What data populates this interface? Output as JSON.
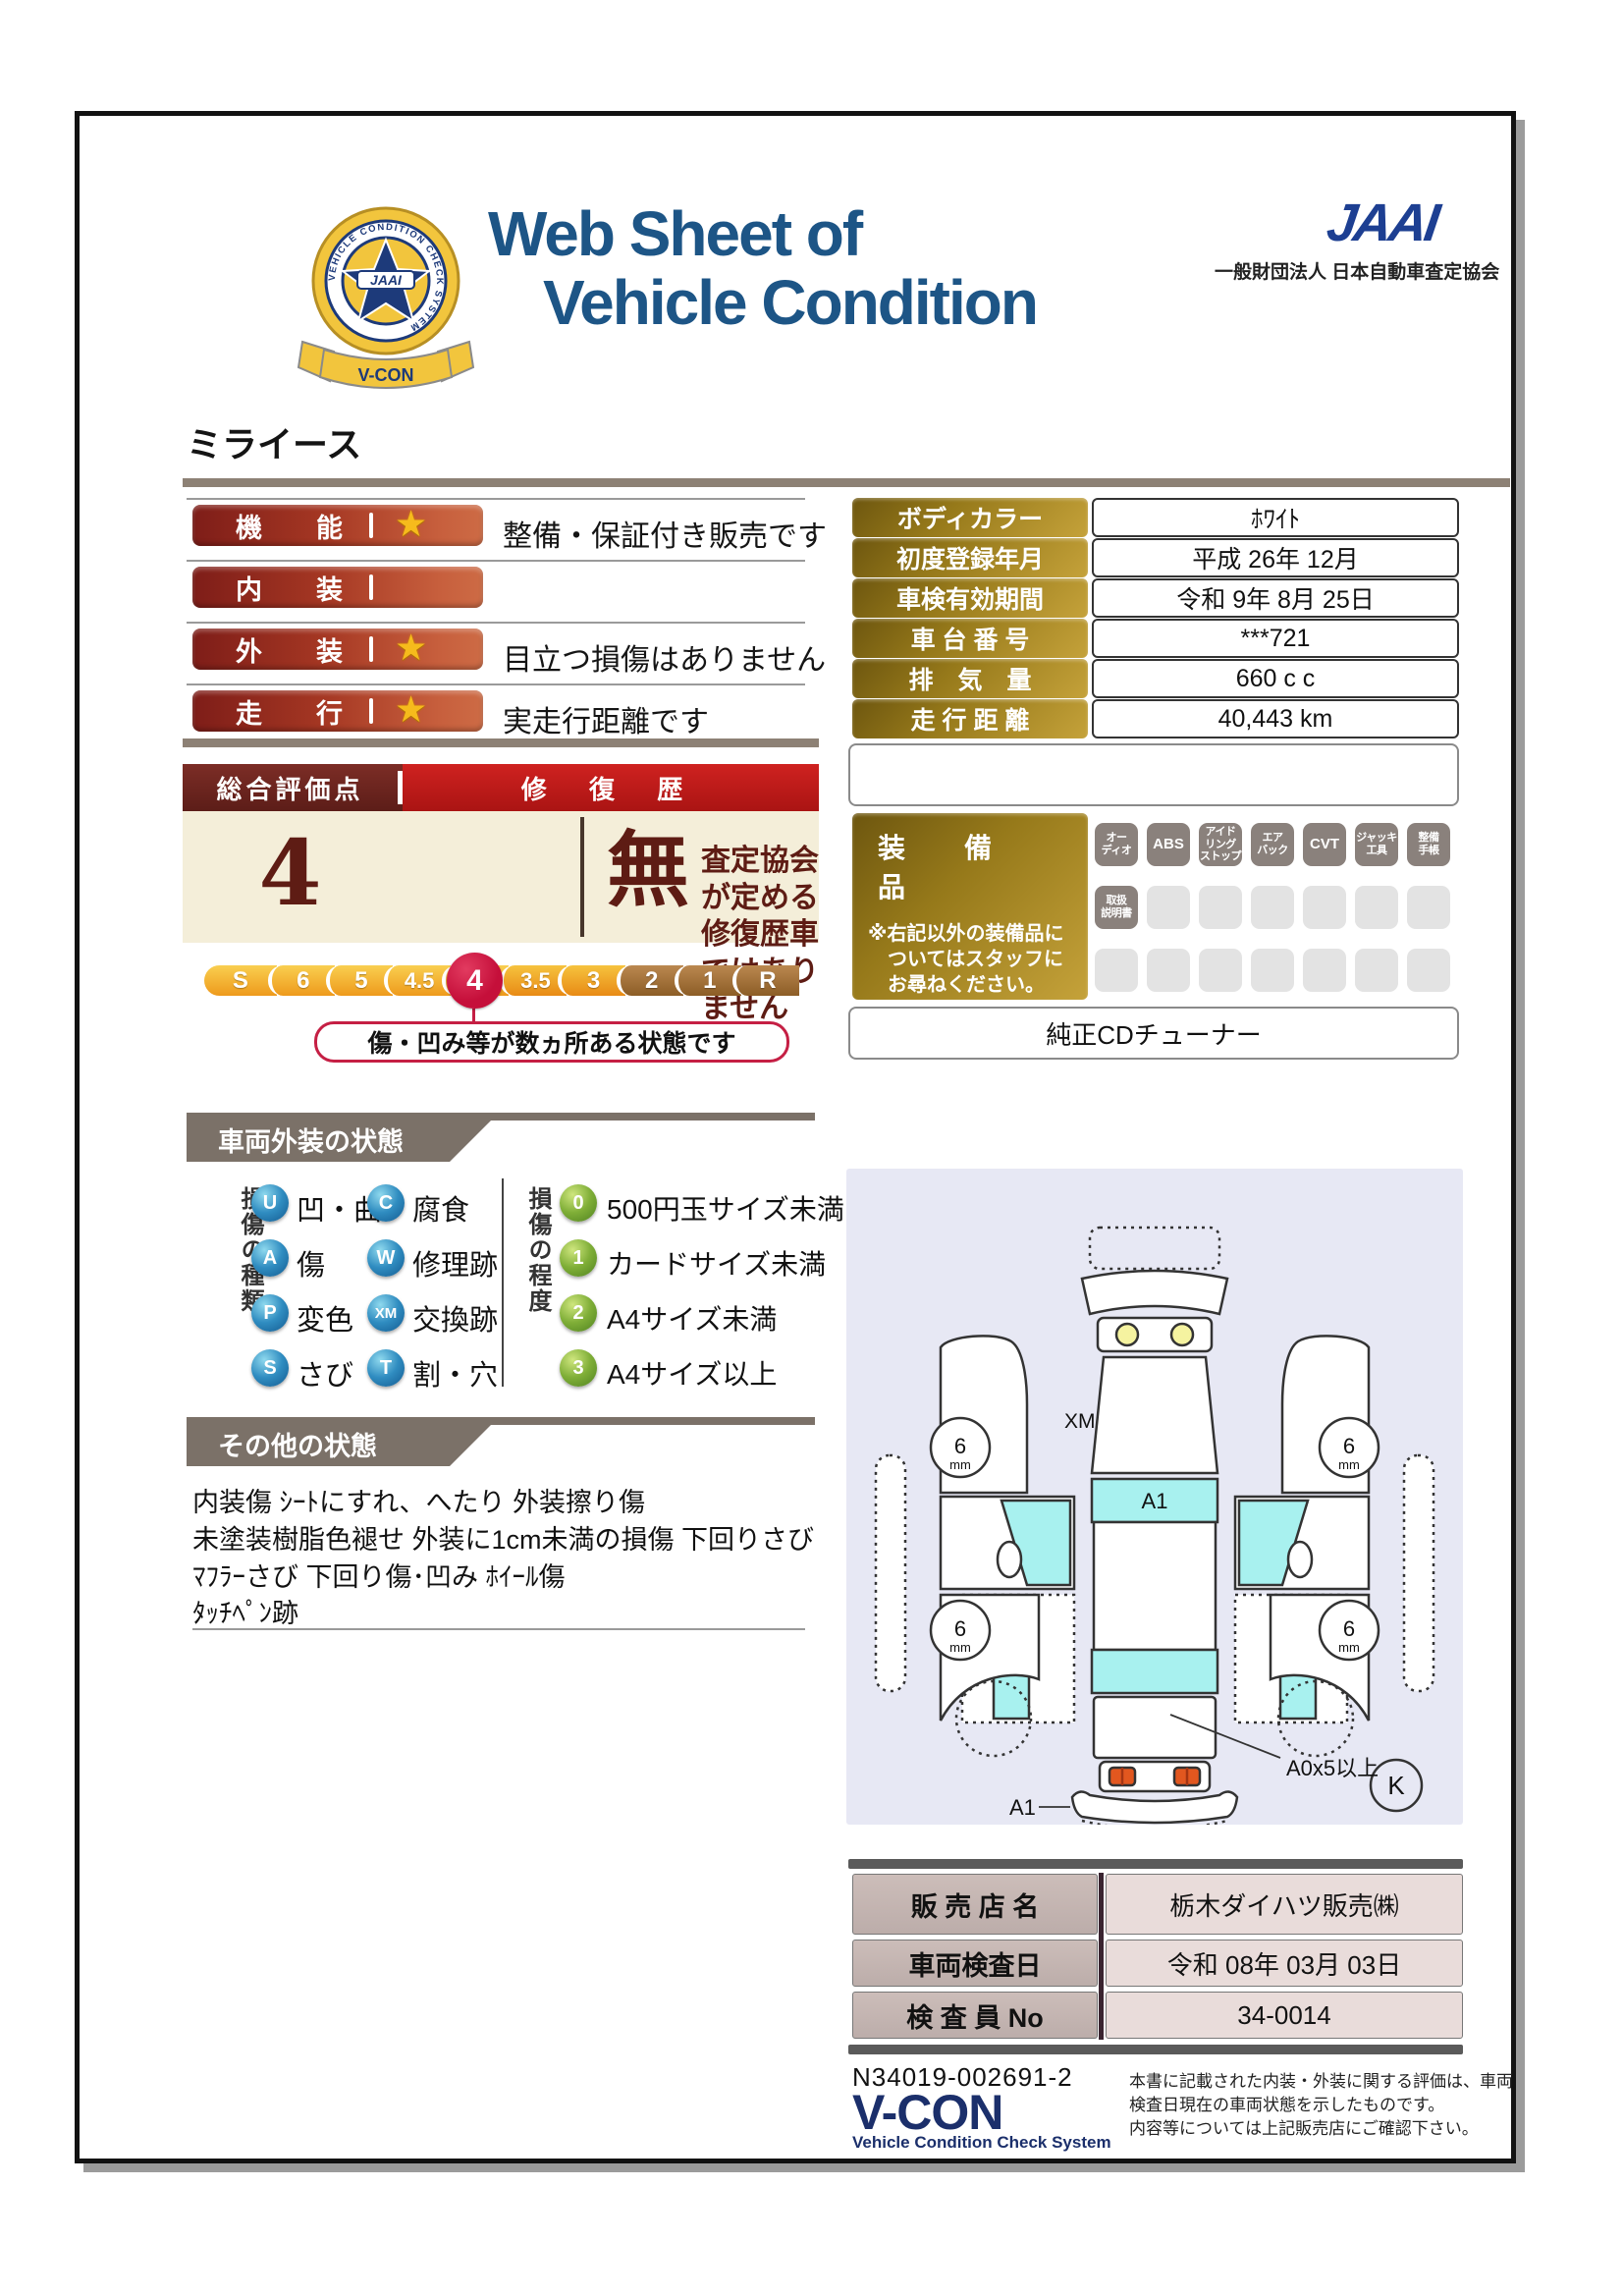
{
  "header": {
    "title_line1": "Web Sheet of",
    "title_line2": "Vehicle Condition",
    "emblem": {
      "jaai": "JAAI",
      "ring_text": "VEHICLE CONDITION CHECK SYSTEM",
      "ribbon": "V-CON"
    },
    "jaai_logo": "JAAI",
    "jaai_org": "一般財団法人 日本自動車査定協会"
  },
  "vehicle_name": "ミライース",
  "ratings": [
    {
      "label": "機　能",
      "note": "整備・保証付き販売です"
    },
    {
      "label": "内　装",
      "note": ""
    },
    {
      "label": "外　装",
      "note": "目立つ損傷はありません"
    },
    {
      "label": "走　行",
      "note": "実走行距離です"
    }
  ],
  "star_glyph": "★",
  "overall": {
    "header_left": "総合評価点",
    "header_right": "修 復 歴",
    "score": "4",
    "repair_flag": "無",
    "repair_note_line1": "査定協会が定める",
    "repair_note_line2": "修復歴車ではありません",
    "scale": [
      "S",
      "6",
      "5",
      "4.5",
      "4",
      "3.5",
      "3",
      "2",
      "1",
      "R"
    ],
    "selected": "4",
    "callout": "傷・凹み等が数ヵ所ある状態です",
    "accent_color": "#c50f3a"
  },
  "info_table": {
    "rows": [
      {
        "label": "ボディカラー",
        "value": "ﾎﾜｲﾄ"
      },
      {
        "label": "初度登録年月",
        "value": "平成 26年 12月"
      },
      {
        "label": "車検有効期間",
        "value": "令和 9年 8月 25日"
      },
      {
        "label": "車 台 番 号",
        "value": "***721"
      },
      {
        "label": "排　気　量",
        "value": "660 c c"
      },
      {
        "label": "走 行 距 離",
        "value": "40,443 km"
      }
    ]
  },
  "equipment": {
    "title": "装　備　品",
    "note_line1": "※右記以外の装備品に",
    "note_line2": "ついてはスタッフに",
    "note_line3": "お尋ねください。",
    "badges_row1": [
      "オー\nディオ",
      "ABS",
      "アイド\nリング\nストップ",
      "エア\nバック",
      "CVT",
      "ジャッキ\n工具",
      "整備\n手帳"
    ],
    "badges_row2": [
      "取扱\n説明書"
    ],
    "extra": "純正CDチューナー"
  },
  "exterior": {
    "header": "車両外装の状態",
    "type_label": "損傷の種類",
    "types": [
      {
        "code": "U",
        "label": "凹・曲"
      },
      {
        "code": "C",
        "label": "腐食"
      },
      {
        "code": "A",
        "label": "傷"
      },
      {
        "code": "W",
        "label": "修理跡"
      },
      {
        "code": "P",
        "label": "変色"
      },
      {
        "code": "XM",
        "label": "交換跡"
      },
      {
        "code": "S",
        "label": "さび"
      },
      {
        "code": "T",
        "label": "割・穴"
      }
    ],
    "degree_label": "損傷の程度",
    "degrees": [
      {
        "code": "0",
        "label": "500円玉サイズ未満"
      },
      {
        "code": "1",
        "label": "カードサイズ未満"
      },
      {
        "code": "2",
        "label": "A4サイズ未満"
      },
      {
        "code": "3",
        "label": "A4サイズ以上"
      }
    ]
  },
  "other": {
    "header": "その他の状態",
    "line1": "内装傷 ｼｰﾄにすれ、へたり 外装擦り傷",
    "line2": "未塗装樹脂色褪せ 外装に1cm未満の損傷 下回りさび",
    "line3": "ﾏﾌﾗｰさび 下回り傷･凹み ﾎｲｰﾙ傷",
    "line4": "ﾀｯﾁﾍﾟﾝ跡"
  },
  "diagram": {
    "xm": "XM",
    "a1_roof": "A1",
    "a1_bumper": "A1",
    "a0": "A0x5以上",
    "k": "K",
    "mm_value": "6",
    "mm_unit": "mm"
  },
  "dealer": {
    "rows": [
      {
        "label": "販 売 店 名",
        "value": "栃木ダイハツ販売㈱"
      },
      {
        "label": "車両検査日",
        "value": "令和 08年 03月 03日"
      },
      {
        "label": "検 査 員 No",
        "value": "34-0014"
      }
    ]
  },
  "footer": {
    "doc_no": "N34019-002691-2",
    "vcon": "V-CON",
    "vcon_sub": "Vehicle Condition Check System",
    "disclaimer_line1": "本書に記載された内装・外装に関する評価は、車両",
    "disclaimer_line2": "検査日現在の車両状態を示したものです。",
    "disclaimer_line3": "内容等については上記販売店にご確認下さい。"
  }
}
